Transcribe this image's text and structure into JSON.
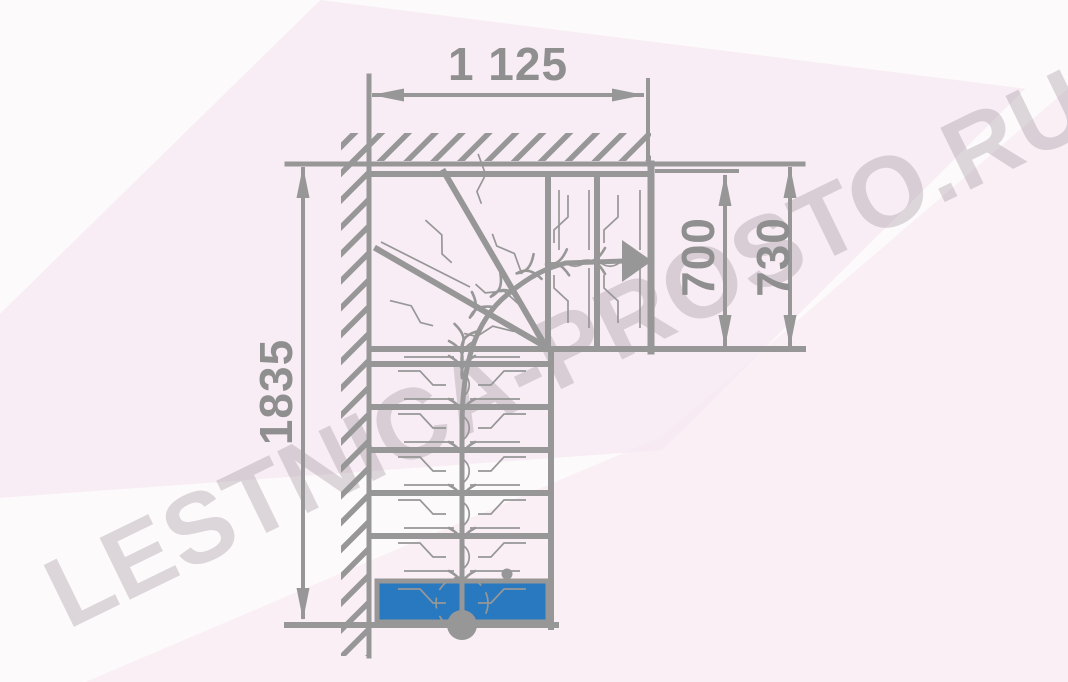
{
  "watermark": {
    "text": "LESTNICA-PROSTO.RU"
  },
  "dimensions": {
    "top_width": "1 125",
    "total_height": "1835",
    "upper_flight_inner": "700",
    "upper_flight_outer": "730"
  },
  "colors": {
    "line": "#979797",
    "dimension_text": "#8f8f8f",
    "first_step_fill": "#2879BF",
    "watermark": "#8a7d88",
    "background": "#fdfafb",
    "background_pink": "#f6e8f1"
  }
}
